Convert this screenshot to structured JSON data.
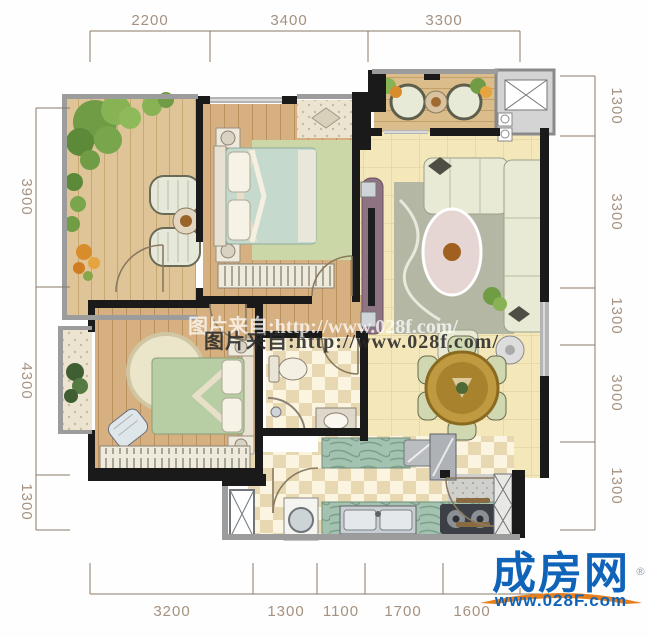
{
  "dimensions": {
    "top": [
      "2200",
      "3400",
      "3300"
    ],
    "left": [
      "3900",
      "4300",
      "1300"
    ],
    "right": [
      "1300",
      "3300",
      "1300",
      "3000",
      "1300"
    ],
    "bottom": [
      "3200",
      "1300",
      "1100",
      "1700",
      "1600"
    ]
  },
  "watermark": {
    "line1": "图片来自:http://www.028f.com/",
    "line2": "图片来自:http://www.028f.com/"
  },
  "logo": {
    "brand": "成房网",
    "registered": "®",
    "url": "www.028F.com"
  },
  "colors": {
    "wall": "#1a1a1a",
    "window_frame": "#9c9c9c",
    "wood_floor": "#d6b080",
    "balcony_wood": "#dfc497",
    "tile_floor": "#f4e7ba",
    "dimension_text": "#a5917f",
    "logo_blue": "#0f63b8",
    "logo_orange": "#e67e1a"
  }
}
